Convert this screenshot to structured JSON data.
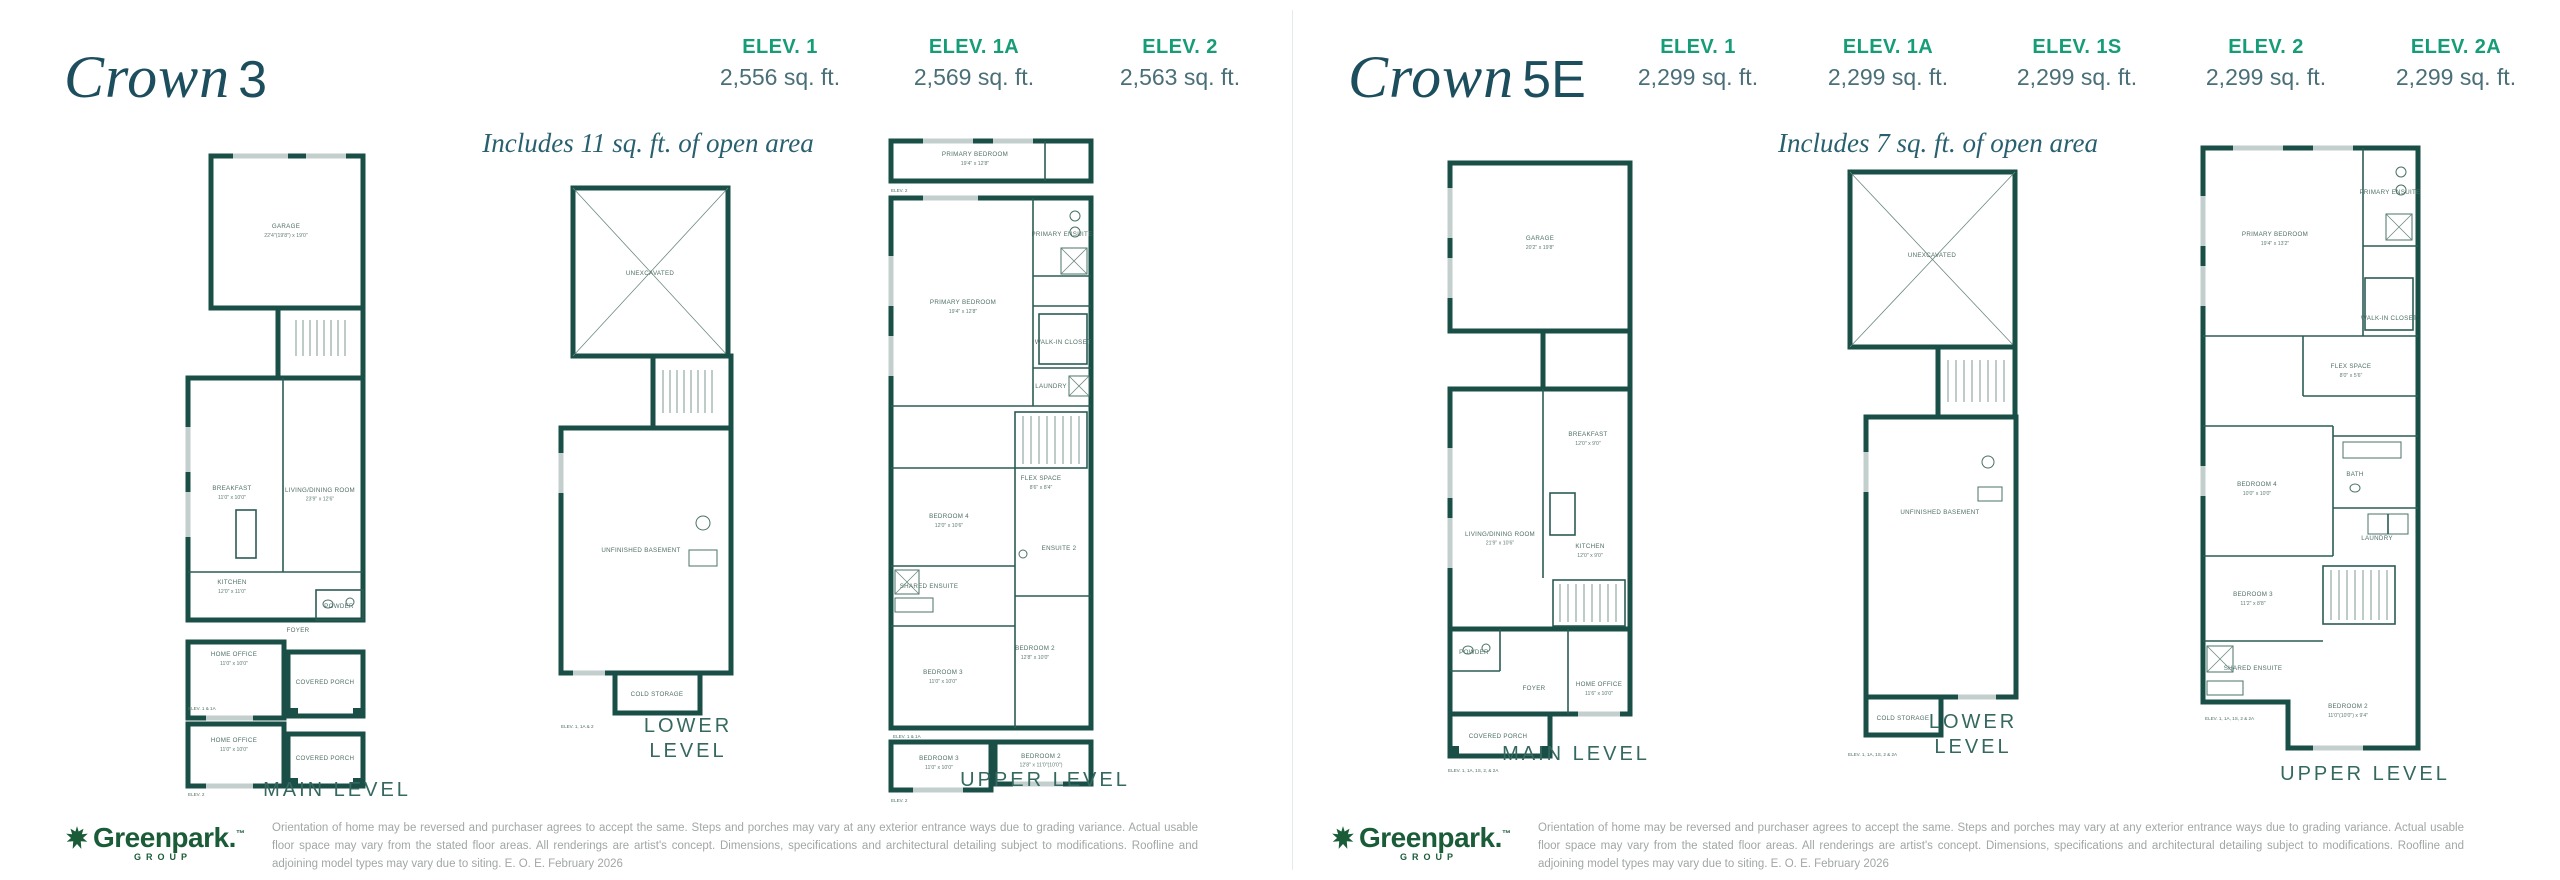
{
  "colors": {
    "title": "#1c4e5e",
    "elev_label_green": "#169c77",
    "sqft_gray": "#4a6f79",
    "wall_teal": "#194f46",
    "logo_green": "#1a5c38"
  },
  "panels": [
    {
      "title_script": "Crown",
      "title_suffix": "3",
      "subtitle": "Includes 11 sq. ft. of open area",
      "elevations": [
        {
          "label": "ELEV. 1",
          "sqft": "2,556 sq. ft."
        },
        {
          "label": "ELEV. 1A",
          "sqft": "2,569 sq. ft."
        },
        {
          "label": "ELEV. 2",
          "sqft": "2,563 sq. ft."
        }
      ],
      "levels": {
        "main": {
          "label": "MAIN LEVEL",
          "rooms": [
            {
              "name": "GARAGE",
              "dims": "22'4\"(19'8\") x 19'0\"",
              "x": 108,
              "y": 86
            },
            {
              "name": "BREAKFAST",
              "dims": "11'0\" x 10'0\"",
              "x": 54,
              "y": 348
            },
            {
              "name": "LIVING/DINING ROOM",
              "dims": "23'9\" x 12'6\"",
              "x": 142,
              "y": 350,
              "fs": 5.6
            },
            {
              "name": "KITCHEN",
              "dims": "12'0\" x 11'0\"",
              "x": 54,
              "y": 442
            },
            {
              "name": "FOYER",
              "x": 120,
              "y": 490,
              "fs": 6
            },
            {
              "name": "POWDER",
              "x": 161,
              "y": 466,
              "fs": 4.4
            },
            {
              "name": "HOME OFFICE",
              "dims": "11'0\" x 10'0\"",
              "x": 56,
              "y": 514
            },
            {
              "name": "COVERED PORCH",
              "x": 147,
              "y": 542,
              "fs": 5
            },
            {
              "name": "HOME OFFICE",
              "dims": "11'0\" x 10'0\"",
              "x": 56,
              "y": 600
            },
            {
              "name": "COVERED PORCH",
              "x": 147,
              "y": 618,
              "fs": 5
            }
          ],
          "notes": [
            {
              "text": "ELEV. 1 & 1A",
              "x": 10,
              "y": 568
            },
            {
              "text": "ELEV. 2",
              "x": 10,
              "y": 654
            }
          ]
        },
        "lower": {
          "label": "LOWER LEVEL",
          "rooms": [
            {
              "name": "UNEXCAVATED",
              "x": 97,
              "y": 97,
              "fs": 7
            },
            {
              "name": "UNFINISHED BASEMENT",
              "x": 88,
              "y": 374,
              "fs": 7
            },
            {
              "name": "COLD STORAGE",
              "x": 104,
              "y": 518,
              "fs": 5.5
            }
          ],
          "notes": [
            {
              "text": "ELEV. 1, 1A & 2",
              "x": 8,
              "y": 550
            }
          ]
        },
        "upper": {
          "label": "UPPER LEVEL",
          "rooms": [
            {
              "name": "PRIMARY BEDROOM",
              "dims": "19'4\" x 12'8\"",
              "x": 92,
              "y": 20,
              "fs": 6
            },
            {
              "name": "PRIMARY BEDROOM",
              "dims": "19'4\" x 12'8\"",
              "x": 80,
              "y": 168
            },
            {
              "name": "PRIMARY ENSUITE",
              "x": 179,
              "y": 100,
              "fs": 4.4
            },
            {
              "name": "WALK-IN CLOSET",
              "x": 180,
              "y": 208,
              "fs": 4.4
            },
            {
              "name": "LAUNDRY",
              "x": 168,
              "y": 252,
              "fs": 4.8
            },
            {
              "name": "FLEX SPACE",
              "dims": "8'6\" x 8'4\"",
              "x": 158,
              "y": 344,
              "fs": 6
            },
            {
              "name": "BEDROOM 4",
              "dims": "12'0\" x 10'6\"",
              "x": 66,
              "y": 382
            },
            {
              "name": "SHARED ENSUITE",
              "x": 46,
              "y": 452,
              "fs": 4.4
            },
            {
              "name": "ENSUITE 2",
              "x": 176,
              "y": 414,
              "fs": 4.6
            },
            {
              "name": "BEDROOM 2",
              "dims": "12'8\" x 10'0\"",
              "x": 152,
              "y": 514
            },
            {
              "name": "BEDROOM 3",
              "dims": "11'0\" x 10'0\"",
              "x": 60,
              "y": 538
            },
            {
              "name": "BEDROOM 3",
              "dims": "11'0\" x 10'0\"",
              "x": 56,
              "y": 624
            },
            {
              "name": "BEDROOM 2",
              "dims": "12'8\" x 11'0\"(10'0\")",
              "x": 158,
              "y": 622,
              "fs": 5.4
            }
          ],
          "notes": [
            {
              "text": "ELEV. 2",
              "x": 8,
              "y": 56
            },
            {
              "text": "ELEV. 1 & 1A",
              "x": 10,
              "y": 602
            },
            {
              "text": "ELEV. 2",
              "x": 8,
              "y": 666
            }
          ]
        }
      }
    },
    {
      "title_script": "Crown",
      "title_suffix": "5E",
      "subtitle": "Includes 7 sq. ft. of open area",
      "elevations": [
        {
          "label": "ELEV. 1",
          "sqft": "2,299 sq. ft."
        },
        {
          "label": "ELEV. 1A",
          "sqft": "2,299 sq. ft."
        },
        {
          "label": "ELEV. 1S",
          "sqft": "2,299 sq. ft."
        },
        {
          "label": "ELEV. 2",
          "sqft": "2,299 sq. ft."
        },
        {
          "label": "ELEV. 2A",
          "sqft": "2,299 sq. ft."
        }
      ],
      "levels": {
        "main": {
          "label": "MAIN LEVEL",
          "rooms": [
            {
              "name": "GARAGE",
              "dims": "20'2\" x 19'8\"",
              "x": 102,
              "y": 92
            },
            {
              "name": "BREAKFAST",
              "dims": "12'0\" x 9'0\"",
              "x": 150,
              "y": 288
            },
            {
              "name": "LIVING/DINING ROOM",
              "dims": "21'9\" x 10'6\"",
              "x": 62,
              "y": 388,
              "fs": 5.6
            },
            {
              "name": "KITCHEN",
              "dims": "12'0\" x 9'0\"",
              "x": 152,
              "y": 400
            },
            {
              "name": "POWDER",
              "x": 36,
              "y": 506,
              "fs": 4.4
            },
            {
              "name": "FOYER",
              "x": 96,
              "y": 542,
              "fs": 6
            },
            {
              "name": "HOME OFFICE",
              "dims": "11'6\" x 10'0\"",
              "x": 161,
              "y": 538
            },
            {
              "name": "COVERED PORCH",
              "x": 60,
              "y": 590,
              "fs": 5
            },
            {
              "name": "MAIN LEVEL",
              "x": 0,
              "y": -100,
              "fs": 0.1
            }
          ],
          "notes": [
            {
              "text": "ELEV. 1, 1A, 1S, 2, & 2A",
              "x": 10,
              "y": 624
            }
          ]
        },
        "lower": {
          "label": "LOWER LEVEL",
          "rooms": [
            {
              "name": "UNEXCAVATED",
              "x": 94,
              "y": 95,
              "fs": 7
            },
            {
              "name": "UNFINISHED BASEMENT",
              "x": 102,
              "y": 352,
              "fs": 6.5
            },
            {
              "name": "COLD STORAGE",
              "x": 65,
              "y": 558,
              "fs": 5.3
            }
          ],
          "notes": [
            {
              "text": "ELEV. 1, 1A, 1S, 2 & 2A",
              "x": 10,
              "y": 594
            }
          ]
        },
        "upper": {
          "label": "UPPER LEVEL",
          "rooms": [
            {
              "name": "PRIMARY BEDROOM",
              "dims": "19'4\" x 13'2\"",
              "x": 82,
              "y": 100
            },
            {
              "name": "PRIMARY ENSUITE",
              "x": 197,
              "y": 58,
              "fs": 4.4
            },
            {
              "name": "WALK-IN CLOSET",
              "x": 196,
              "y": 184,
              "fs": 4.4
            },
            {
              "name": "FLEX SPACE",
              "dims": "8'0\" x 5'6\"",
              "x": 158,
              "y": 232,
              "fs": 6
            },
            {
              "name": "BEDROOM 4",
              "dims": "10'0\" x 10'0\"",
              "x": 64,
              "y": 350
            },
            {
              "name": "BATH",
              "x": 162,
              "y": 340,
              "fs": 5.5
            },
            {
              "name": "LAUNDRY",
              "x": 184,
              "y": 404,
              "fs": 4.8
            },
            {
              "name": "BEDROOM 3",
              "dims": "11'2\" x 8'8\"",
              "x": 60,
              "y": 460
            },
            {
              "name": "SHARED ENSUITE",
              "x": 60,
              "y": 534,
              "fs": 4.4
            },
            {
              "name": "BEDROOM 2",
              "dims": "11'0\"(10'0\") x 9'4\"",
              "x": 155,
              "y": 572,
              "fs": 6
            }
          ],
          "notes": [
            {
              "text": "ELEV. 1, 1A, 1S, 2 & 2A",
              "x": 12,
              "y": 584
            }
          ]
        }
      }
    }
  ],
  "footer": {
    "brand": "Greenpark",
    "brand_dot": ".",
    "tm": "™",
    "sub": "GROUP",
    "disclaimer": "Orientation of home may be reversed and purchaser agrees to accept the same. Steps and porches may vary at any exterior entrance ways due to grading variance. Actual usable floor space may vary from the stated floor areas. All renderings are artist's concept. Dimensions, specifications and architectural detailing subject to modifications. Roofline and adjoining model types may vary due to siting. E. O. E. February 2026"
  }
}
